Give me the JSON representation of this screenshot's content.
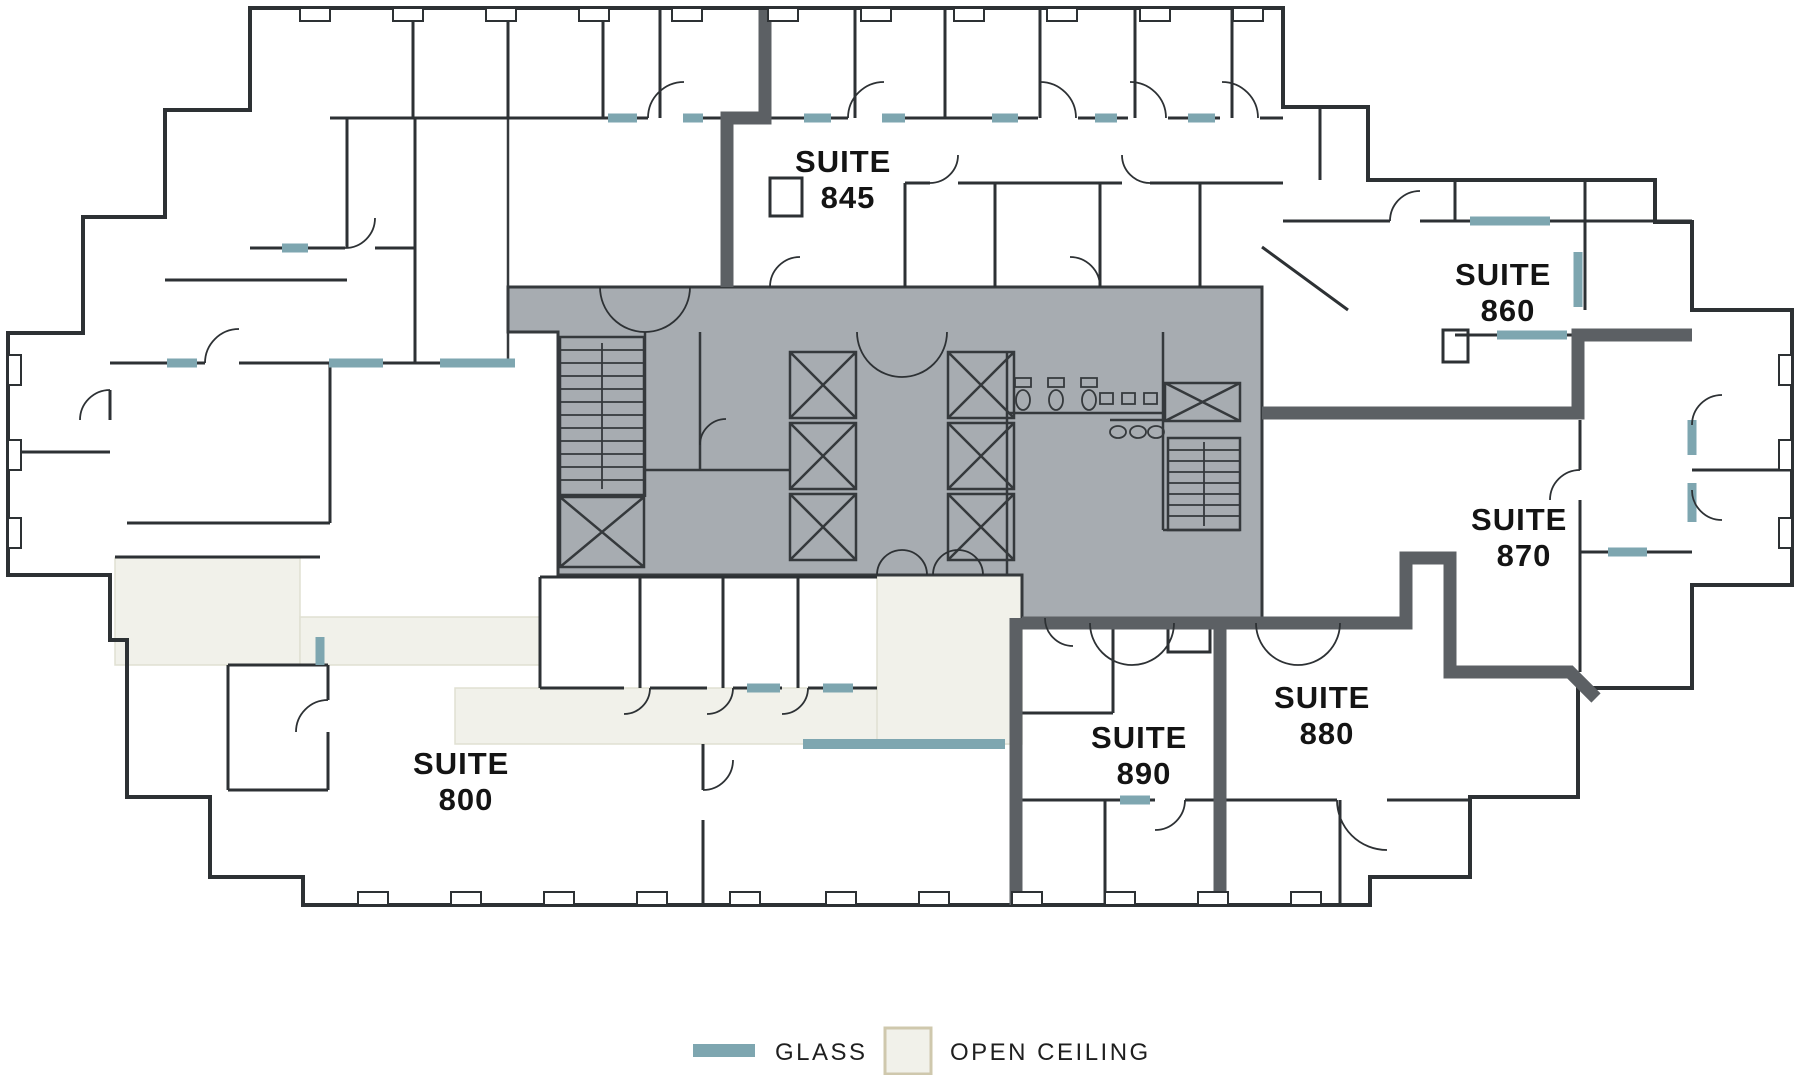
{
  "suites": [
    {
      "id": "800",
      "word": "SUITE",
      "number": "800"
    },
    {
      "id": "845",
      "word": "SUITE",
      "number": "845"
    },
    {
      "id": "860",
      "word": "SUITE",
      "number": "860"
    },
    {
      "id": "870",
      "word": "SUITE",
      "number": "870"
    },
    {
      "id": "880",
      "word": "SUITE",
      "number": "880"
    },
    {
      "id": "890",
      "word": "SUITE",
      "number": "890"
    }
  ],
  "legend": {
    "glass": {
      "label": "GLASS",
      "swatch_color": "#7ea6b0"
    },
    "open_ceiling": {
      "label": "OPEN CEILING",
      "swatch_fill": "#f1f1ea",
      "swatch_border": "#cfc8ad"
    }
  },
  "colors": {
    "background": "#ffffff",
    "wall": "#2d3134",
    "demising_wall": "#5c6064",
    "core_fill": "#a7acb1",
    "glass": "#7ea6b0",
    "open_ceiling_fill": "#f1f1ea",
    "label_text": "#141414"
  }
}
